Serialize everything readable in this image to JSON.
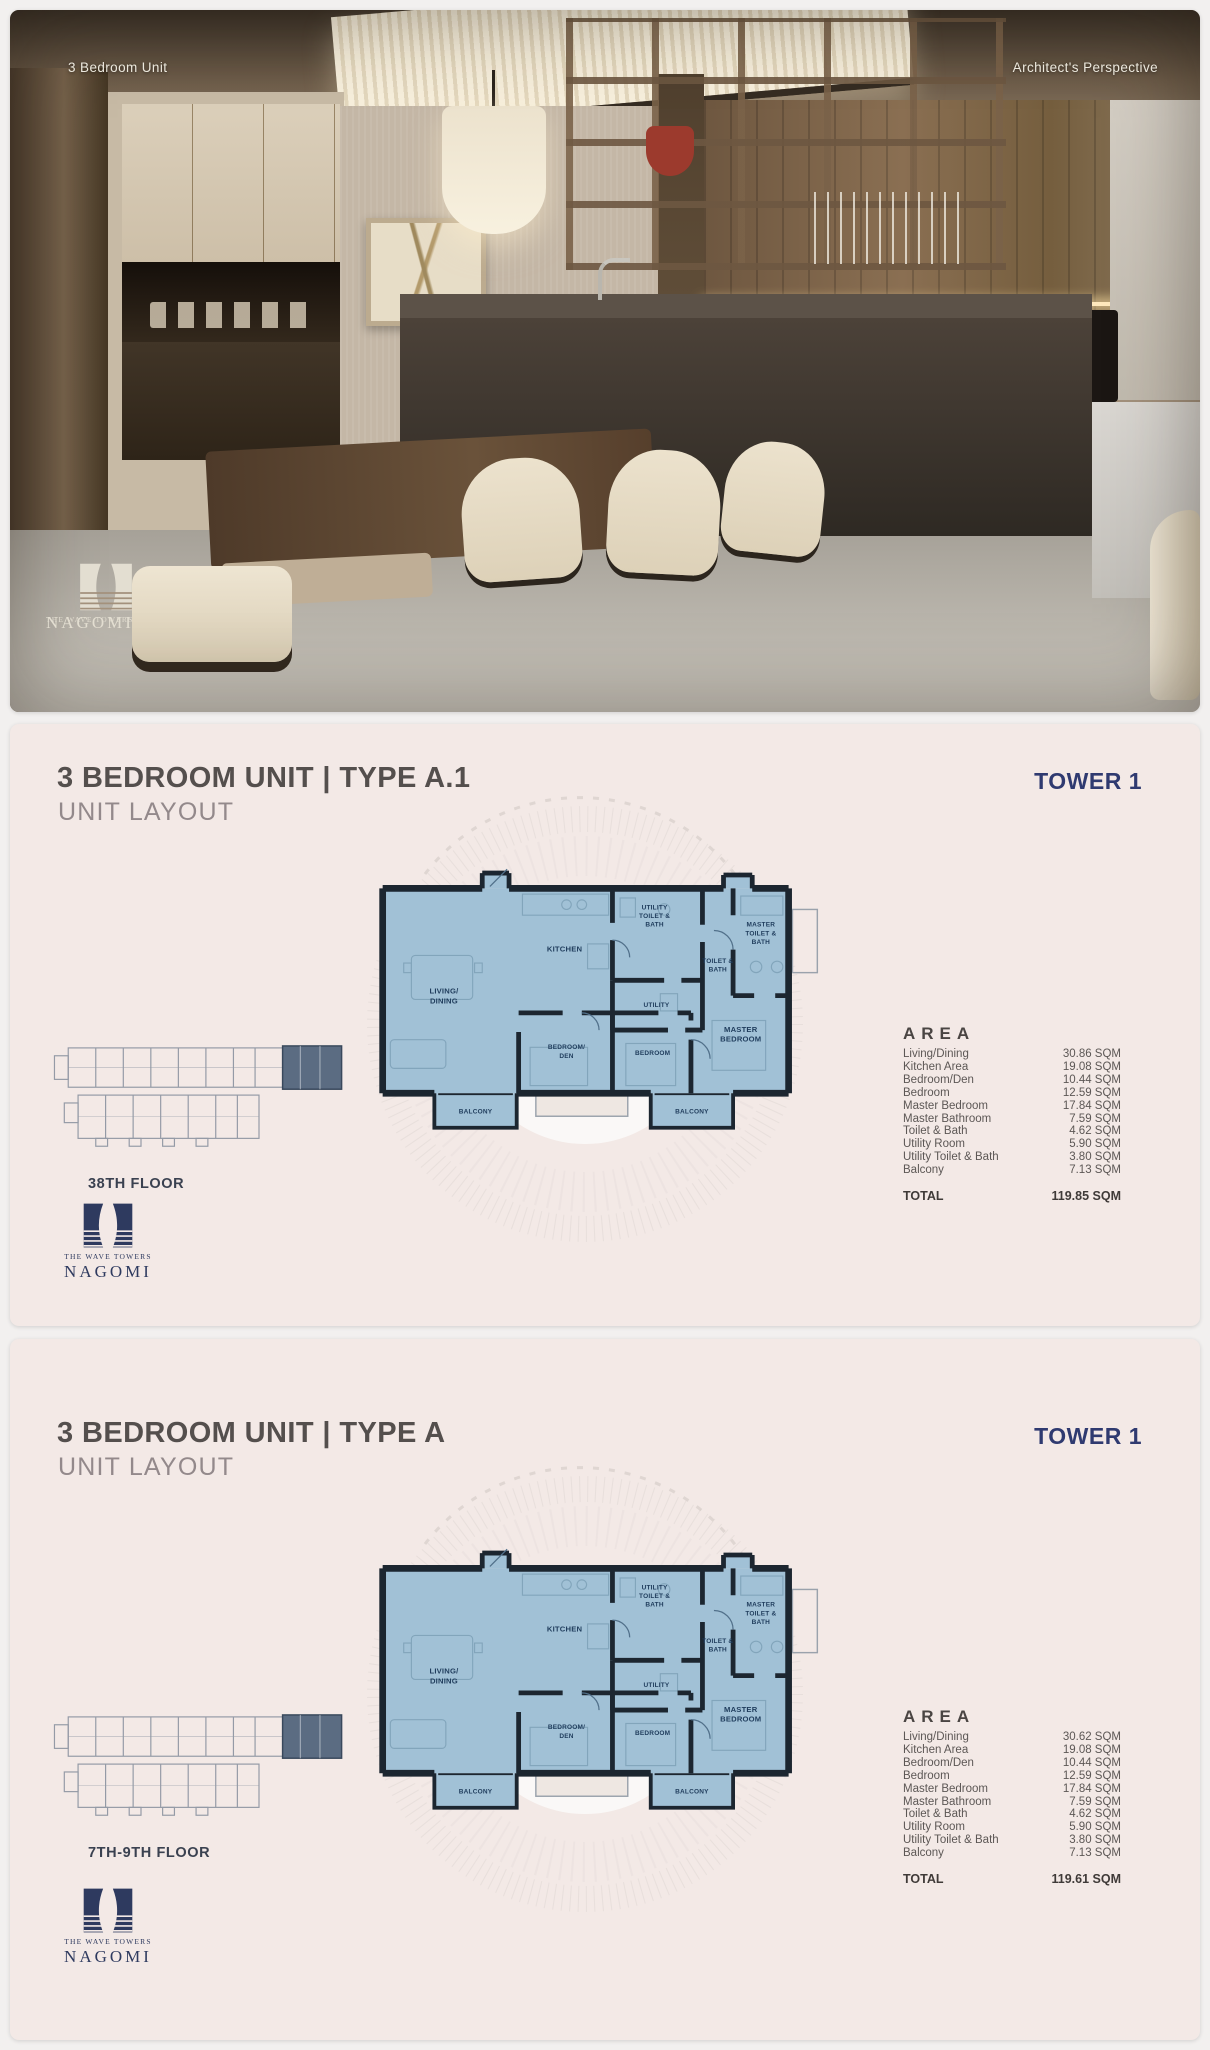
{
  "photo": {
    "caption_left": "3 Bedroom Unit",
    "caption_right": "Architect's Perspective"
  },
  "brand": {
    "tagline": "THE WAVE TOWERS",
    "name": "NAGOMI"
  },
  "floorplan_labels": {
    "living1": "LIVING/",
    "living2": "DINING",
    "kitchen": "KITCHEN",
    "utility_tb1": "UTILITY",
    "utility_tb2": "TOILET &",
    "utility_tb3": "BATH",
    "utility": "UTILITY",
    "tb1": "TOILET &",
    "tb2": "BATH",
    "master_tb1": "MASTER",
    "master_tb2": "TOILET &",
    "master_tb3": "BATH",
    "master_br1": "MASTER",
    "master_br2": "BEDROOM",
    "bedroom_den1": "BEDROOM/",
    "bedroom_den2": "DEN",
    "bedroom": "BEDROOM",
    "balcony": "BALCONY"
  },
  "panels": [
    {
      "title": "3 BEDROOM UNIT | TYPE A.1",
      "subtitle": "UNIT LAYOUT",
      "tower": "TOWER 1",
      "floor_label": "38TH FLOOR",
      "area": {
        "heading": "AREA",
        "rows": [
          {
            "label": "Living/Dining",
            "value": "30.86 SQM"
          },
          {
            "label": "Kitchen Area",
            "value": "19.08 SQM"
          },
          {
            "label": "Bedroom/Den",
            "value": "10.44 SQM"
          },
          {
            "label": "Bedroom",
            "value": "12.59 SQM"
          },
          {
            "label": "Master Bedroom",
            "value": "17.84 SQM"
          },
          {
            "label": "Master Bathroom",
            "value": "7.59 SQM"
          },
          {
            "label": "Toilet & Bath",
            "value": "4.62 SQM"
          },
          {
            "label": "Utility Room",
            "value": "5.90 SQM"
          },
          {
            "label": "Utility Toilet & Bath",
            "value": "3.80 SQM"
          },
          {
            "label": "Balcony",
            "value": "7.13 SQM"
          }
        ],
        "total_label": "TOTAL",
        "total_value": "119.85 SQM"
      }
    },
    {
      "title": "3 BEDROOM UNIT | TYPE A",
      "subtitle": "UNIT LAYOUT",
      "tower": "TOWER 1",
      "floor_label": "7TH-9TH FLOOR",
      "area": {
        "heading": "AREA",
        "rows": [
          {
            "label": "Living/Dining",
            "value": "30.62 SQM"
          },
          {
            "label": "Kitchen Area",
            "value": "19.08 SQM"
          },
          {
            "label": "Bedroom/Den",
            "value": "10.44 SQM"
          },
          {
            "label": "Bedroom",
            "value": "12.59 SQM"
          },
          {
            "label": "Master Bedroom",
            "value": "17.84 SQM"
          },
          {
            "label": "Master Bathroom",
            "value": "7.59 SQM"
          },
          {
            "label": "Toilet & Bath",
            "value": "4.62 SQM"
          },
          {
            "label": "Utility Room",
            "value": "5.90 SQM"
          },
          {
            "label": "Utility Toilet & Bath",
            "value": "3.80 SQM"
          },
          {
            "label": "Balcony",
            "value": "7.13 SQM"
          }
        ],
        "total_label": "TOTAL",
        "total_value": "119.61 SQM"
      }
    }
  ],
  "colors": {
    "accent_navy": "#2f3a70",
    "panel_background": "#f3e9e6",
    "plan_fill": "#a1c1d6",
    "plan_wall": "#1c2630",
    "keyplan_highlight": "#5b6c82"
  }
}
